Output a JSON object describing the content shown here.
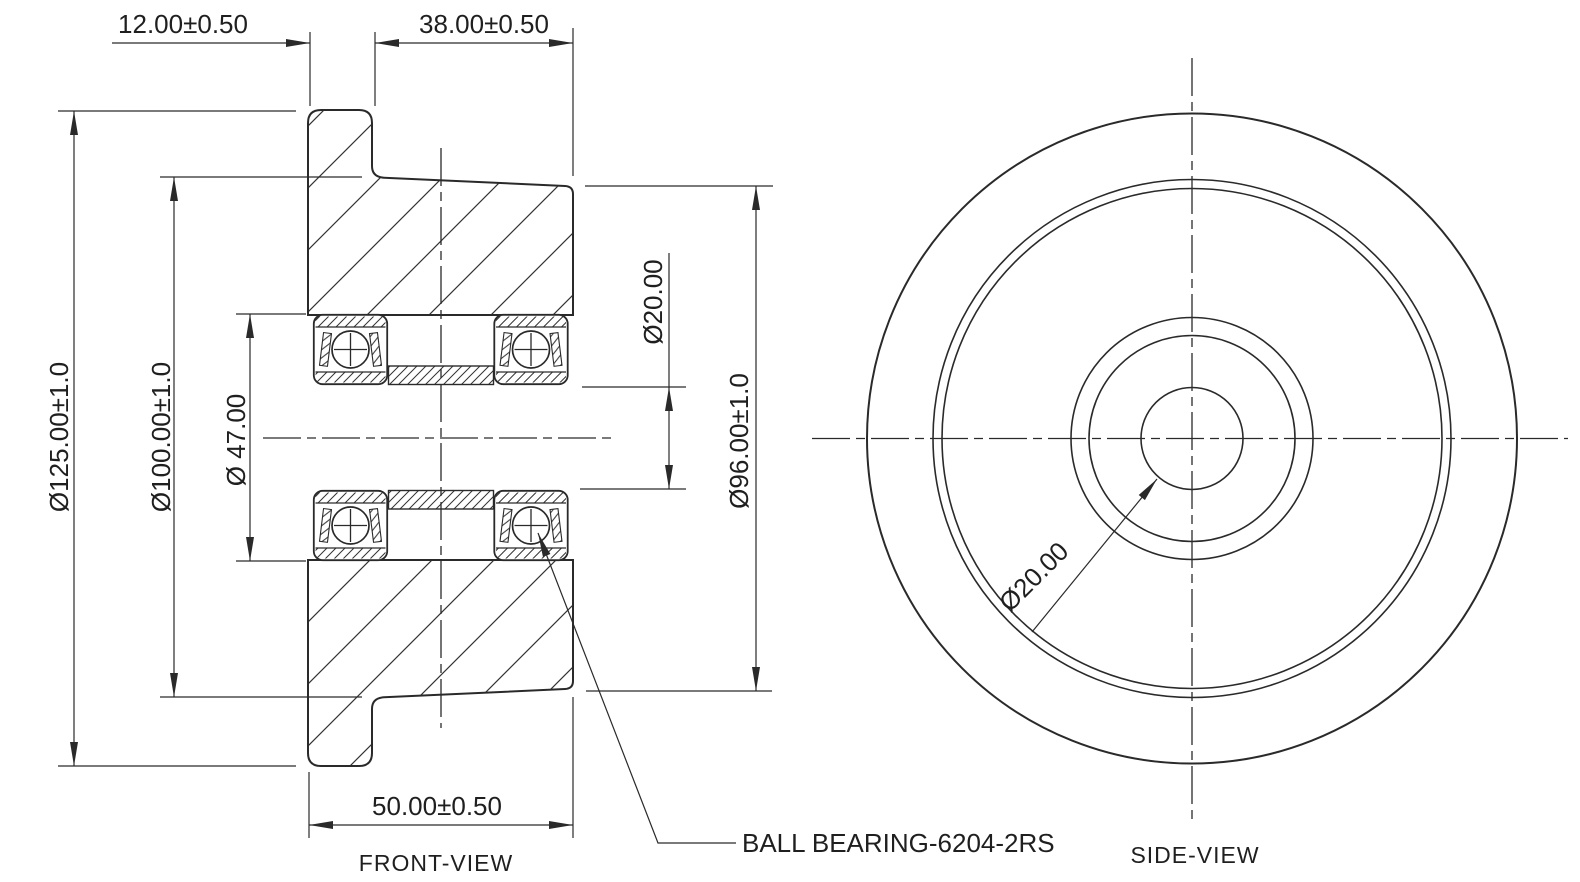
{
  "drawing_title": "Flanged wheel with ball bearings",
  "colors": {
    "background": "#ffffff",
    "line": "#2a2a2a",
    "text": "#1f1f1f"
  },
  "front_view": {
    "label": "FRONT-VIEW",
    "dims": {
      "flange_width": "12.00±0.50",
      "hub_width": "38.00±0.50",
      "outer_dia": "Ø125.00±1.0",
      "major_dia": "Ø100.00±1.0",
      "bearing_seat_dia": "Ø 47.00",
      "bore_dia": "Ø20.00",
      "minor_dia": "Ø96.00±1.0",
      "overall_width": "50.00±0.50"
    },
    "callout": "BALL BEARING-6204-2RS"
  },
  "side_view": {
    "label": "SIDE-VIEW",
    "dims": {
      "bore_dia": "Ø20.00"
    }
  }
}
